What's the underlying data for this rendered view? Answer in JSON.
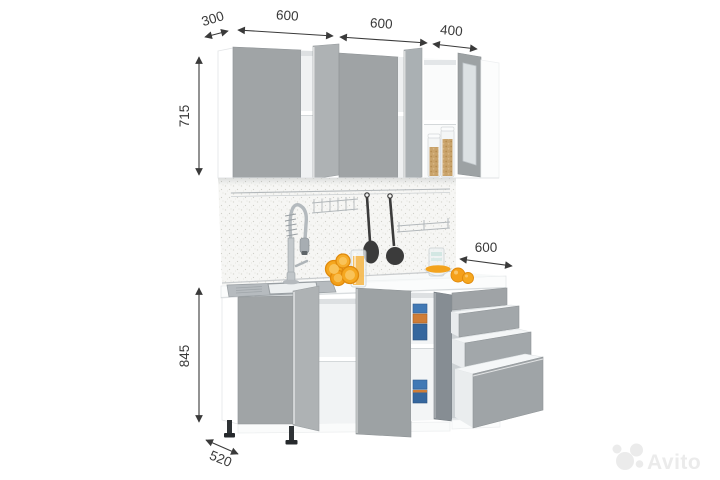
{
  "image": {
    "description": "3D render of a grey and white straight kitchen set with opened cabinets and drawers, sink, faucet and accessories, annotated with dimensions",
    "background": "#ffffff"
  },
  "annotations": {
    "top": [
      {
        "id": "wall-cabinet-depth",
        "label": "300"
      },
      {
        "id": "wall-cabinet-width-1",
        "label": "600"
      },
      {
        "id": "wall-cabinet-width-2",
        "label": "600"
      },
      {
        "id": "wall-cabinet-width-3",
        "label": "400"
      }
    ],
    "left": [
      {
        "id": "wall-cabinet-height",
        "label": "715"
      },
      {
        "id": "base-cabinet-height",
        "label": "845"
      }
    ],
    "right": [
      {
        "id": "drawer-unit-width",
        "label": "600"
      }
    ],
    "bottom": [
      {
        "id": "base-cabinet-depth",
        "label": "520"
      }
    ]
  },
  "watermark": {
    "brand": "Avito",
    "color": "#ebebeb"
  },
  "colors": {
    "door_gray": "#a0a4a6",
    "door_gray_light": "#aeb2b4",
    "door_gray_dark": "#8b9093",
    "carcass_white": "#ffffff",
    "dimension_ink": "#3a3a3a",
    "accent_orange": "#f5a41e",
    "container_blue": "#3a6fa8",
    "grain_tan": "#c9a36b"
  }
}
